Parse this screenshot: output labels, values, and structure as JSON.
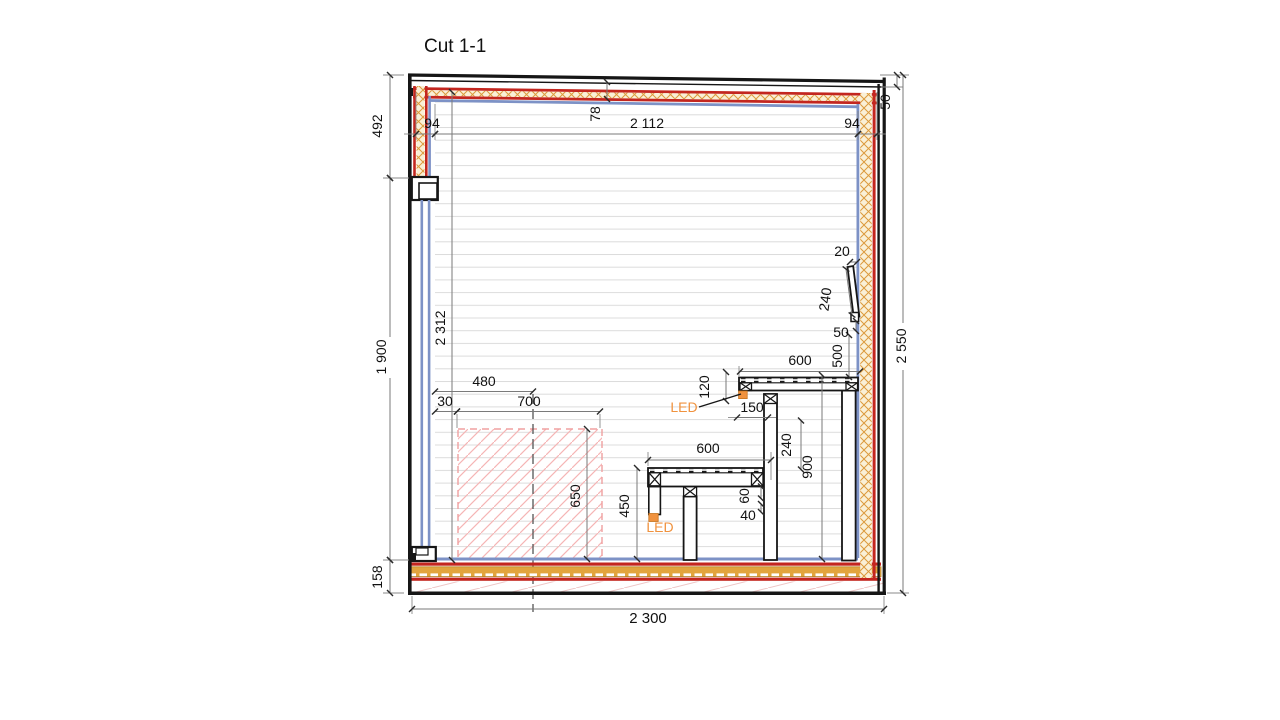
{
  "title": "Cut 1-1",
  "colors": {
    "outline": "#161616",
    "layer_red": "#c3261f",
    "layer_orange": "#dc9a3c",
    "layer_blue": "#7d92c6",
    "panel_line": "#dcdcdc",
    "heater_hatch": "#f5b5b5",
    "led_accent": "#f0923e",
    "dim_line": "#7a7a7a"
  },
  "annotations": {
    "led_upper": "LED",
    "led_lower": "LED"
  },
  "dims": {
    "top_left_94": "94",
    "ceiling_span": "2 112",
    "top_right_94": "94",
    "ceiling_slope_78": "78",
    "roof_edge_50": "50",
    "left_492": "492",
    "left_1900": "1 900",
    "left_158": "158",
    "right_2550": "2 550",
    "bottom_2300": "2 300",
    "interior_2312": "2 312",
    "heater_center_480": "480",
    "gap_30": "30",
    "heater_width_700": "700",
    "heater_height_650": "650",
    "bench_low_height_450": "450",
    "bench_low_width_600": "600",
    "bench_edge_60": "60",
    "bench_lath_40": "40",
    "bench_up_width_600": "600",
    "bench_up_drop_120": "120",
    "support_offset_150": "150",
    "bench_step_240": "240",
    "bench_up_height_900": "900",
    "backrest_top_gap_20": "20",
    "backrest_length_240": "240",
    "backrest_bottom_gap_50": "50",
    "backrest_to_bench_500": "500"
  }
}
